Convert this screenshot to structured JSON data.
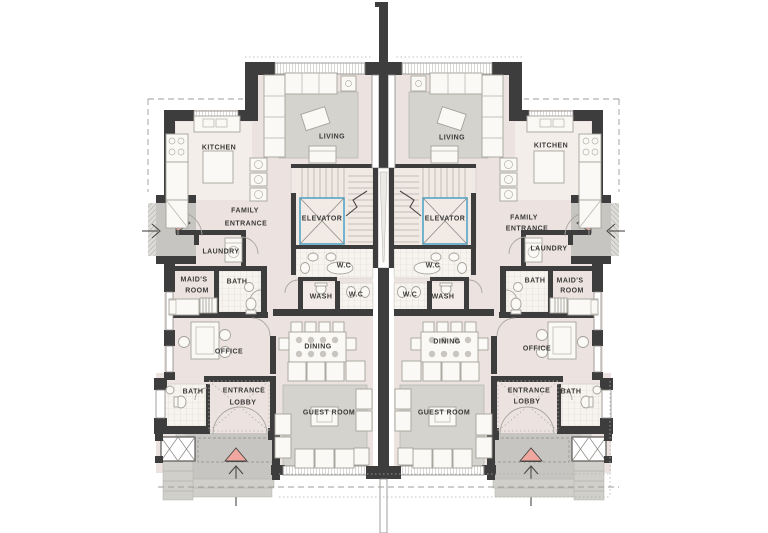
{
  "colors": {
    "wall": "#3e3d3d",
    "floor": "#ece3e0",
    "floor-light": "#f4eeea",
    "stair-floor": "#f0e9e4",
    "carpet": "#d4d3ce",
    "carpet-edge": "#b8b7b2",
    "porch": "#c6c5c1",
    "step": "#d0cfca",
    "furn": "#fbf9f5",
    "furn-edge": "#a5a29b",
    "accent": "#54a5c6",
    "entry-pink": "#efa7a0",
    "dash": "#9e9c98",
    "label": "#3a3938",
    "win-edge": "#8a8884"
  },
  "units": [
    {
      "side": "left",
      "labels": {
        "kitchen": "KITCHEN",
        "living": "LIVING",
        "family_1": "FAMILY",
        "family_2": "ENTRANCE",
        "elevator": "ELEVATOR",
        "laundry": "LAUNDRY",
        "maids_1": "MAID'S",
        "maids_2": "ROOM",
        "bath_upper": "BATH",
        "wc_main": "W.C",
        "wash": "WASH",
        "wc_small": "W.C",
        "office": "OFFICE",
        "dining": "DINING",
        "bath_lower": "BATH",
        "lobby_1": "ENTRANCE",
        "lobby_2": "LOBBY",
        "guest": "GUEST ROOM"
      }
    },
    {
      "side": "right",
      "labels": {
        "kitchen": "KITCHEN",
        "living": "LIVING",
        "family_1": "FAMILY",
        "family_2": "ENTRANCE",
        "elevator": "ELEVATOR",
        "laundry": "LAUNDRY",
        "maids_1": "MAID'S",
        "maids_2": "ROOM",
        "bath_upper": "BATH",
        "wc_main": "W.C",
        "wash": "WASH",
        "wc_small": "W.C",
        "office": "OFFICE",
        "dining": "DINING",
        "bath_lower": "BATH",
        "lobby_1": "ENTRANCE",
        "lobby_2": "LOBBY",
        "guest": "GUEST ROOM"
      }
    }
  ]
}
